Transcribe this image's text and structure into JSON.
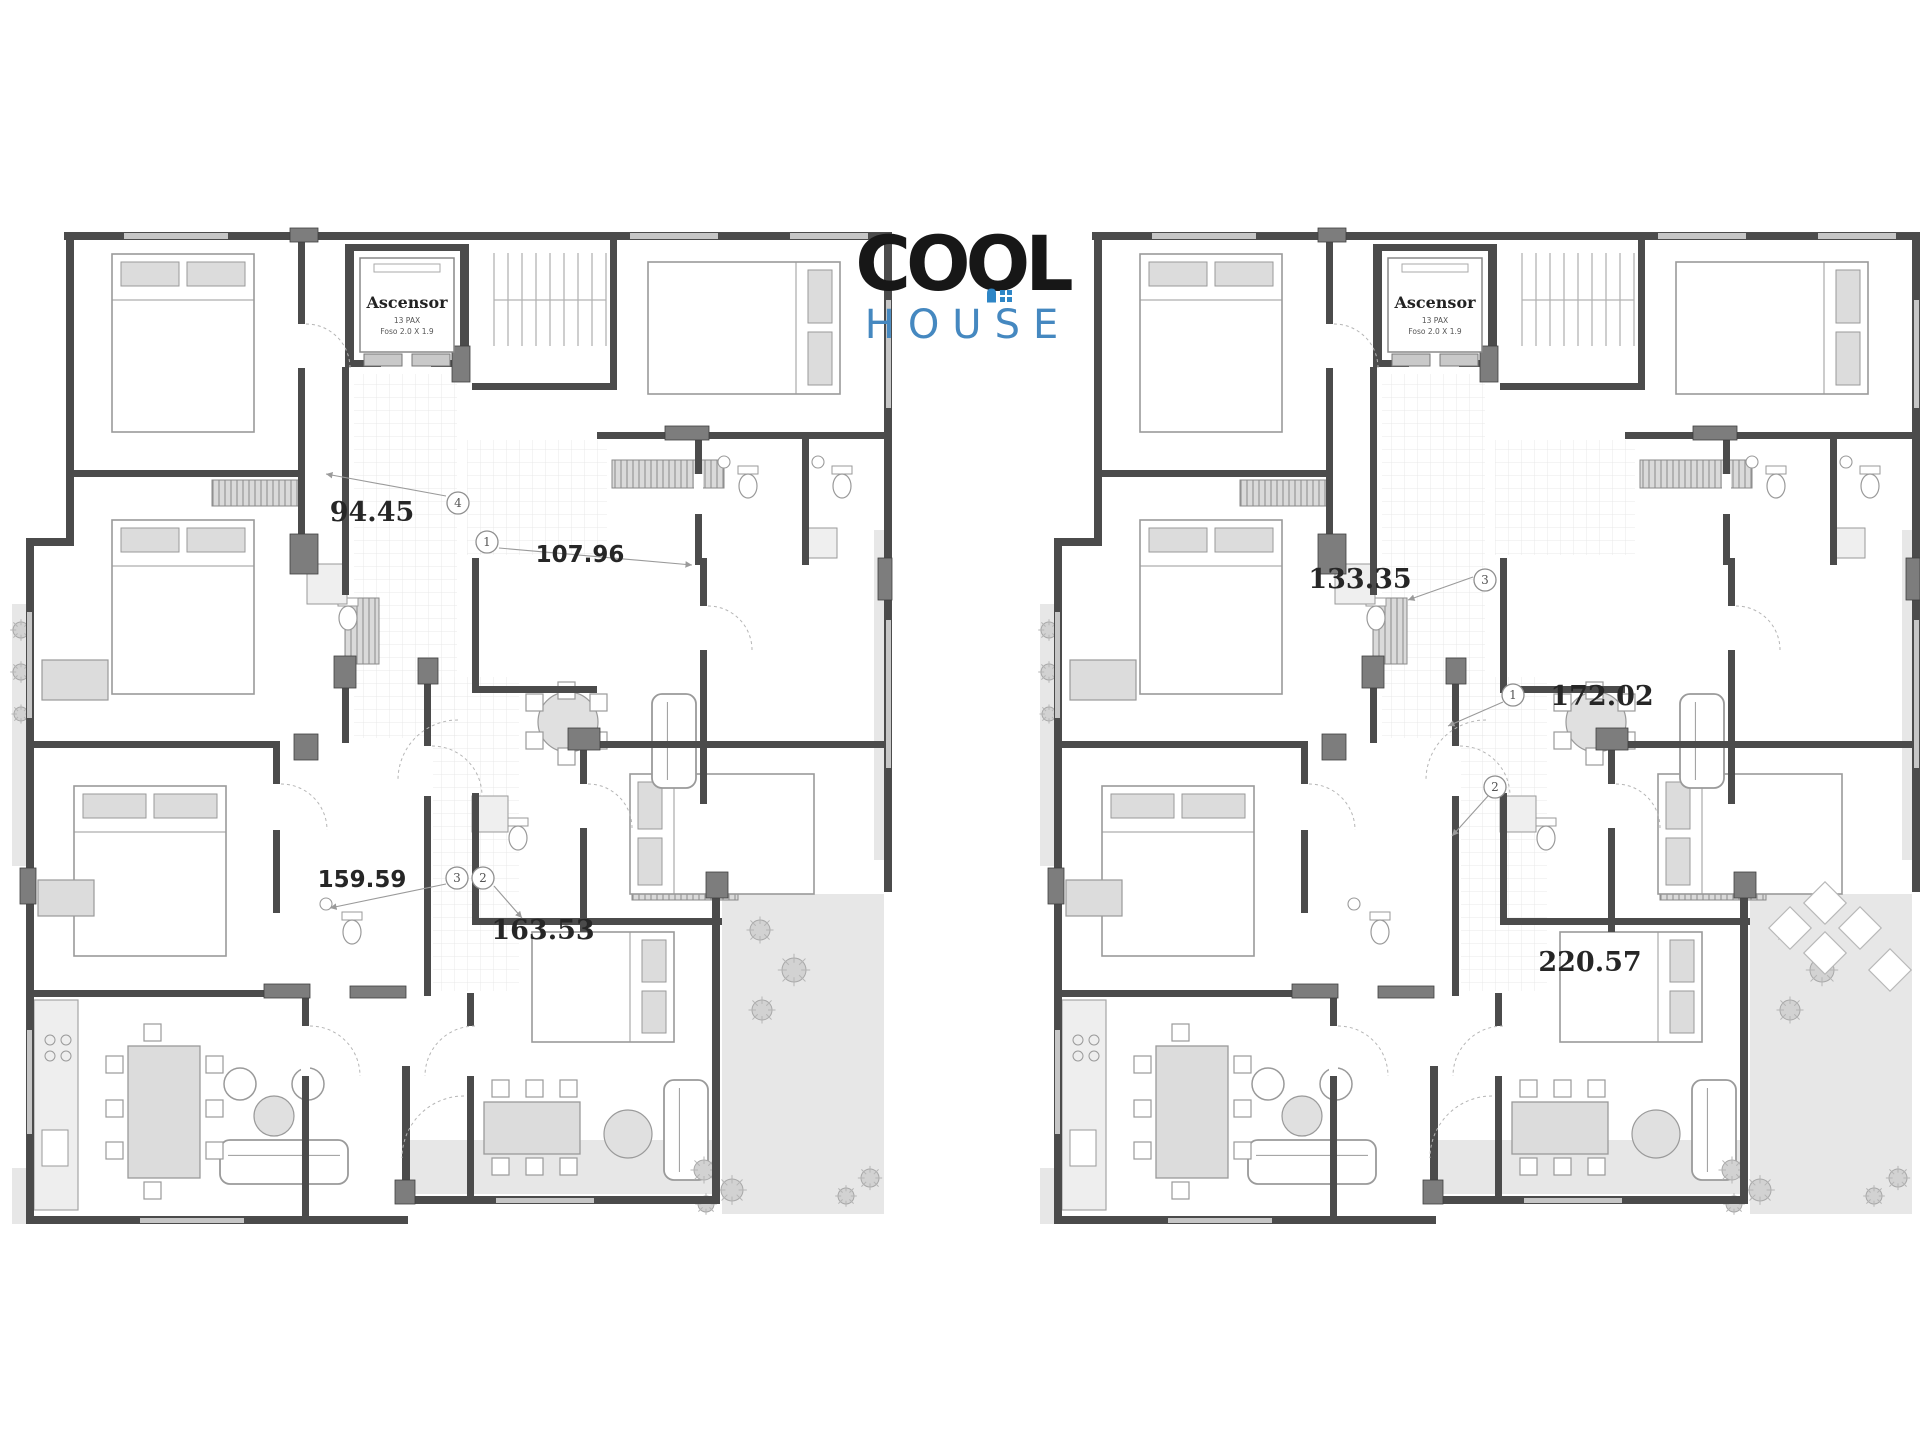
{
  "logo": {
    "word1": "COOL",
    "word2": "HOUSE",
    "word1_color": "#171717",
    "word2_color": "#4588c0",
    "icon_color": "#2e86c6"
  },
  "colors": {
    "wall": "#4b4b4b",
    "pier": "#7d7d7d",
    "window_band": "#c6c6c6",
    "furniture_fill": "#dcdcdc",
    "furniture_stroke": "#9a9a9a",
    "terrace": "#e7e7e7",
    "grid_line": "#e4e4e4",
    "label_color": "#262626",
    "marker_stroke": "#8f8f8f",
    "arc": "#b5b5b5",
    "leader": "#9a9a9a"
  },
  "plans": [
    {
      "name": "floor-plan-left",
      "origin_x": 12,
      "origin_y": 228,
      "pavers": false,
      "elevator": {
        "title": "Ascensor",
        "capacity": "13 PAX",
        "pit": "Foso 2.0 X 1.9"
      },
      "area_labels": [
        {
          "value": "94.45",
          "x": 372,
          "y": 521,
          "font": "serif"
        },
        {
          "value": "107.96",
          "x": 580,
          "y": 562,
          "font": "sans"
        },
        {
          "value": "159.59",
          "x": 362,
          "y": 887,
          "font": "sans"
        },
        {
          "value": "163.53",
          "x": 543,
          "y": 939,
          "font": "serif"
        }
      ],
      "unit_markers": [
        {
          "n": "4",
          "x": 458,
          "y": 503
        },
        {
          "n": "1",
          "x": 487,
          "y": 542
        },
        {
          "n": "3",
          "x": 457,
          "y": 878
        },
        {
          "n": "2",
          "x": 483,
          "y": 878
        }
      ],
      "leaders": [
        [
          446,
          496,
          326,
          474
        ],
        [
          499,
          548,
          692,
          565
        ],
        [
          446,
          884,
          330,
          908
        ],
        [
          494,
          886,
          522,
          918
        ]
      ]
    },
    {
      "name": "floor-plan-right",
      "origin_x": 1040,
      "origin_y": 228,
      "pavers": true,
      "elevator": {
        "title": "Ascensor",
        "capacity": "13 PAX",
        "pit": "Foso 2.0 X 1.9"
      },
      "area_labels": [
        {
          "value": "133.35",
          "x": 1360,
          "y": 588,
          "font": "serif"
        },
        {
          "value": "172.02",
          "x": 1602,
          "y": 705,
          "font": "serif"
        },
        {
          "value": "220.57",
          "x": 1590,
          "y": 971,
          "font": "serif"
        }
      ],
      "unit_markers": [
        {
          "n": "3",
          "x": 1485,
          "y": 580
        },
        {
          "n": "1",
          "x": 1513,
          "y": 695
        },
        {
          "n": "2",
          "x": 1495,
          "y": 787
        }
      ],
      "leaders": [
        [
          1473,
          577,
          1408,
          600
        ],
        [
          1503,
          702,
          1448,
          726
        ],
        [
          1488,
          796,
          1452,
          836
        ]
      ]
    }
  ]
}
